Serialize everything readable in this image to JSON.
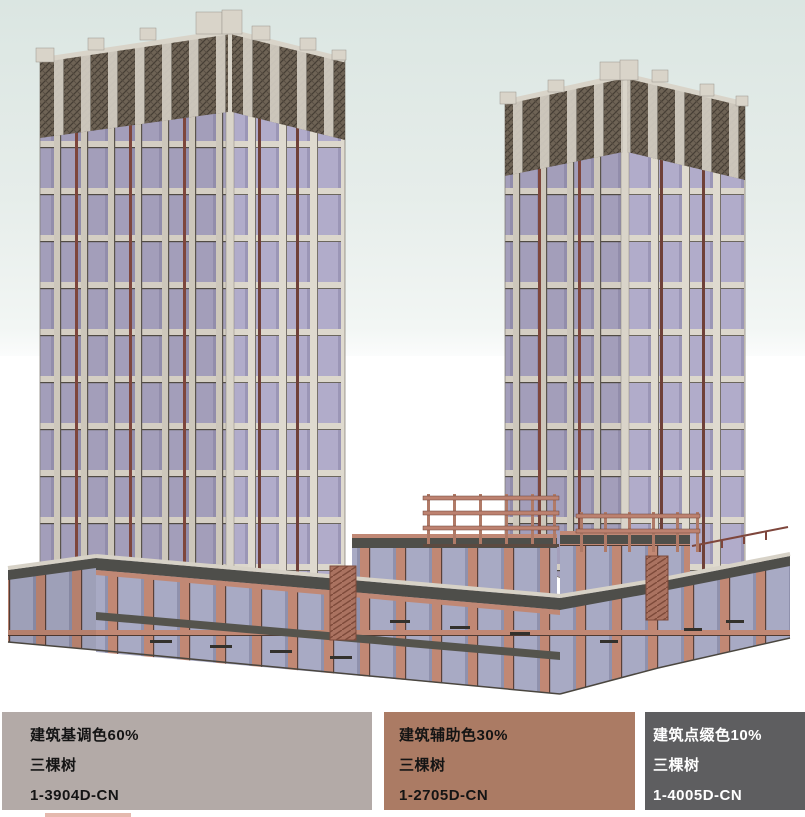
{
  "palette_bar": {
    "swatches": [
      {
        "name": "建筑基调色60%",
        "brand": "三棵树",
        "code": "1-3904D-CN",
        "color": "#b3aaa7",
        "text_color": "#141414"
      },
      {
        "name": "建筑辅助色30%",
        "brand": "三棵树",
        "code": "1-2705D-CN",
        "color": "#ab7b64",
        "text_color": "#141414"
      },
      {
        "name": "建筑点缀色10%",
        "brand": "三棵树",
        "code": "1-4005D-CN",
        "color": "#5e5e60",
        "text_color": "#ffffff"
      }
    ]
  }
}
